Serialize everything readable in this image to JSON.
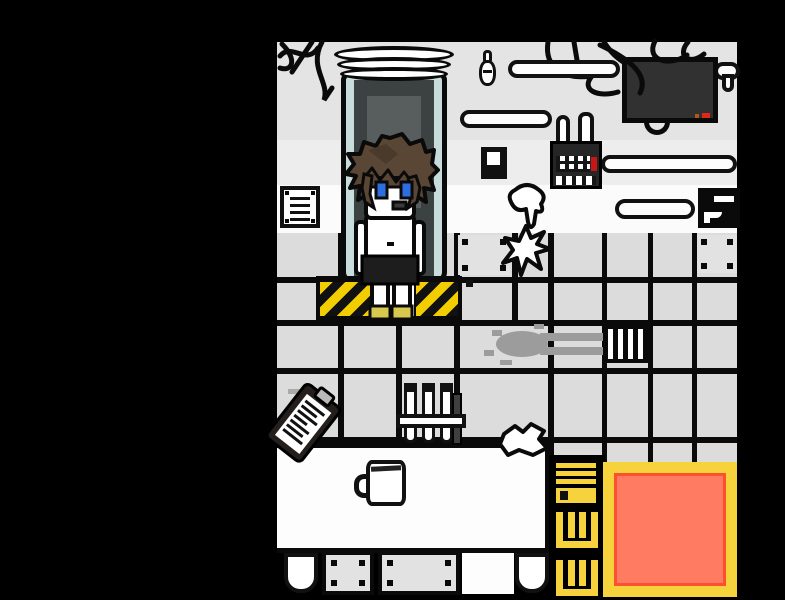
{
  "viewport": {
    "width": 785,
    "height": 600
  },
  "scene_type": "pixel-art laboratory room",
  "palette": {
    "void": "#000000",
    "wall-grey": "#e4e4e4",
    "wall-grey-light": "#ededed",
    "baseboard-white": "#fbfbfb",
    "tile-grey": "#dcdcdc",
    "panel-grey": "#e2e2e2",
    "outline": "#111111",
    "pod-interior": "#3c4142",
    "pod-panel": "#585d5d",
    "pod-glass": "#c9dcdc",
    "hazard-yellow": "#f2cd00",
    "hair-brown": "#5a4634",
    "skin-white": "#ffffff",
    "eye-blue": "#2e6fe0",
    "shorts-black": "#1d1d1d",
    "feet-yellow": "#d9c84e",
    "screen-dark": "#313131",
    "led-red": "#e02818",
    "ladder-yellow": "#f6d33c",
    "mat-orange": "#ff7b61",
    "mat-red": "#ff4f31",
    "smear-grey": "#9c9c9c"
  },
  "objects": {
    "viewport": {
      "label": "game viewport"
    },
    "pod": {
      "label": "stasis pod with white rings"
    },
    "character": {
      "label": "shirtless boy with brown hair and blue eyes"
    },
    "hazard": {
      "label": "yellow-black hazard platform"
    },
    "monitor": {
      "label": "wall-mounted monitor with red LED"
    },
    "wires": {
      "label": "scribbled wall wires"
    },
    "vent": {
      "label": "wall vent grille"
    },
    "calendar": {
      "label": "dark device with tube dials and red mark"
    },
    "switch": {
      "label": "light switch"
    },
    "bulb": {
      "label": "small wall bulb"
    },
    "sign": {
      "label": "black wall sign with white marks"
    },
    "pipes": {
      "label": "white wall pipes"
    },
    "drip": {
      "label": "white dripping goo on baseboard"
    },
    "starburst": {
      "label": "white splat on floor"
    },
    "grate": {
      "label": "floor drain grate"
    },
    "smear": {
      "label": "grey smear dragged toward grate"
    },
    "table": {
      "label": "white lab table"
    },
    "clipboard": {
      "label": "tilted clipboard with scribbled notes"
    },
    "tubes": {
      "label": "test tube rack"
    },
    "mug": {
      "label": "white mug"
    },
    "crumple": {
      "label": "crumpled white paper"
    },
    "pit": {
      "label": "black pit opening"
    },
    "ladder": {
      "label": "yellow ladder into pit"
    },
    "mat": {
      "label": "orange mat with yellow border"
    }
  }
}
